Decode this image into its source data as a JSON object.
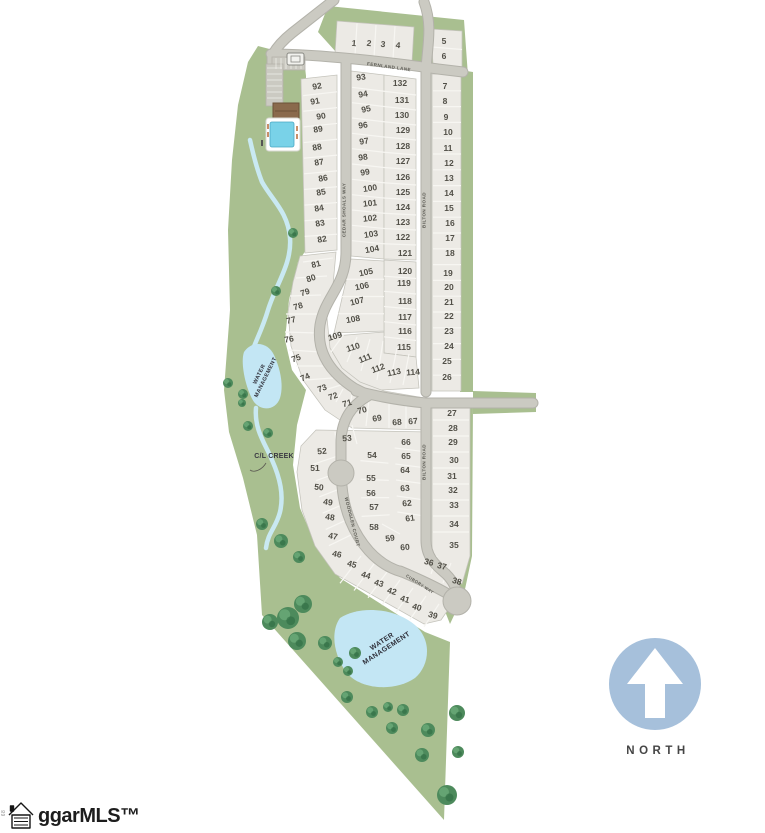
{
  "labels": {
    "fernland_lane": "FERNLAND LANE",
    "cedar_shoals_way": "CEDAR SHOALS WAY",
    "bilton_road_upper": "BILTON ROAD",
    "bilton_road_lower": "BILTON ROAD",
    "woodglen_court": "WOODGLEN COURT",
    "cubory_way": "CUBORY WAY",
    "water_mgmt_upper": "WATER\nMANAGEMENT",
    "water_mgmt_lower": "WATER\nMANAGEMENT",
    "cl_creek": "C/L CREEK",
    "north": "NORTH",
    "logo": "ggarMLS™",
    "edge_mark": "68"
  },
  "colors": {
    "land_green": "#a9bf90",
    "tree_green": "#4d8a5c",
    "lot_fill": "#eceae5",
    "road_fill": "#cbcac2",
    "road_edge": "#b3b2aa",
    "water_blue": "#c3e6f4",
    "pool_blue": "#79d2e8",
    "north_circle": "#a6c0db"
  },
  "lots_format": [
    "label",
    "x",
    "y",
    "rotation_deg"
  ],
  "lots": [
    [
      "1",
      354,
      43,
      6
    ],
    [
      "2",
      369,
      43,
      6
    ],
    [
      "3",
      383,
      44,
      6
    ],
    [
      "4",
      398,
      45,
      6
    ],
    [
      "5",
      444,
      41,
      0
    ],
    [
      "6",
      444,
      56,
      0
    ],
    [
      "7",
      445,
      86,
      0
    ],
    [
      "8",
      445,
      101,
      0
    ],
    [
      "9",
      446,
      117,
      0
    ],
    [
      "10",
      448,
      132,
      0
    ],
    [
      "11",
      448,
      148,
      0
    ],
    [
      "12",
      449,
      163,
      0
    ],
    [
      "13",
      449,
      178,
      0
    ],
    [
      "14",
      449,
      193,
      0
    ],
    [
      "15",
      449,
      208,
      0
    ],
    [
      "16",
      450,
      223,
      0
    ],
    [
      "17",
      450,
      238,
      0
    ],
    [
      "18",
      450,
      253,
      0
    ],
    [
      "19",
      448,
      273,
      0
    ],
    [
      "20",
      449,
      287,
      0
    ],
    [
      "21",
      449,
      302,
      0
    ],
    [
      "22",
      449,
      316,
      0
    ],
    [
      "23",
      449,
      331,
      0
    ],
    [
      "24",
      449,
      346,
      0
    ],
    [
      "25",
      447,
      361,
      0
    ],
    [
      "26",
      447,
      377,
      0
    ],
    [
      "27",
      452,
      413,
      0
    ],
    [
      "28",
      453,
      428,
      0
    ],
    [
      "29",
      453,
      442,
      0
    ],
    [
      "30",
      454,
      460,
      0
    ],
    [
      "31",
      452,
      476,
      0
    ],
    [
      "32",
      453,
      490,
      0
    ],
    [
      "33",
      454,
      505,
      0
    ],
    [
      "34",
      454,
      524,
      0
    ],
    [
      "35",
      454,
      545,
      0
    ],
    [
      "36",
      429,
      562,
      14
    ],
    [
      "37",
      442,
      566,
      14
    ],
    [
      "38",
      457,
      581,
      16
    ],
    [
      "39",
      433,
      615,
      16
    ],
    [
      "40",
      417,
      607,
      16
    ],
    [
      "41",
      405,
      599,
      16
    ],
    [
      "42",
      392,
      591,
      16
    ],
    [
      "43",
      379,
      583,
      16
    ],
    [
      "44",
      366,
      575,
      16
    ],
    [
      "45",
      352,
      564,
      16
    ],
    [
      "46",
      337,
      554,
      12
    ],
    [
      "47",
      333,
      536,
      10
    ],
    [
      "48",
      330,
      517,
      8
    ],
    [
      "49",
      328,
      502,
      8
    ],
    [
      "50",
      319,
      487,
      6
    ],
    [
      "51",
      315,
      468,
      0
    ],
    [
      "52",
      322,
      451,
      -5
    ],
    [
      "53",
      347,
      438,
      -5
    ],
    [
      "54",
      372,
      455,
      0
    ],
    [
      "55",
      371,
      478,
      0
    ],
    [
      "56",
      371,
      493,
      0
    ],
    [
      "57",
      374,
      507,
      0
    ],
    [
      "58",
      374,
      527,
      0
    ],
    [
      "59",
      390,
      538,
      -8
    ],
    [
      "60",
      405,
      547,
      -5
    ],
    [
      "61",
      410,
      518,
      -8
    ],
    [
      "62",
      407,
      503,
      -5
    ],
    [
      "63",
      405,
      488,
      -5
    ],
    [
      "64",
      405,
      470,
      0
    ],
    [
      "65",
      406,
      456,
      0
    ],
    [
      "66",
      406,
      442,
      0
    ],
    [
      "67",
      413,
      421,
      -5
    ],
    [
      "68",
      397,
      422,
      -5
    ],
    [
      "69",
      377,
      418,
      -10
    ],
    [
      "70",
      362,
      410,
      -14
    ],
    [
      "71",
      347,
      403,
      -16
    ],
    [
      "72",
      333,
      396,
      -18
    ],
    [
      "73",
      322,
      388,
      -20
    ],
    [
      "74",
      305,
      377,
      -24
    ],
    [
      "75",
      296,
      358,
      -20
    ],
    [
      "76",
      289,
      339,
      -10
    ],
    [
      "77",
      291,
      320,
      -14
    ],
    [
      "78",
      298,
      306,
      -16
    ],
    [
      "79",
      305,
      292,
      -18
    ],
    [
      "80",
      311,
      278,
      -18
    ],
    [
      "81",
      316,
      264,
      -14
    ],
    [
      "82",
      322,
      239,
      -10
    ],
    [
      "83",
      320,
      223,
      -10
    ],
    [
      "84",
      319,
      208,
      -10
    ],
    [
      "85",
      321,
      192,
      -10
    ],
    [
      "86",
      323,
      178,
      -10
    ],
    [
      "87",
      319,
      162,
      -10
    ],
    [
      "88",
      317,
      147,
      -10
    ],
    [
      "89",
      318,
      129,
      -10
    ],
    [
      "90",
      321,
      116,
      -10
    ],
    [
      "91",
      315,
      101,
      -10
    ],
    [
      "92",
      317,
      86,
      -10
    ],
    [
      "93",
      361,
      77,
      -8
    ],
    [
      "94",
      363,
      94,
      -10
    ],
    [
      "95",
      366,
      109,
      -12
    ],
    [
      "96",
      363,
      125,
      -8
    ],
    [
      "97",
      364,
      141,
      -10
    ],
    [
      "98",
      363,
      157,
      -8
    ],
    [
      "99",
      365,
      172,
      -10
    ],
    [
      "100",
      370,
      188,
      -8
    ],
    [
      "101",
      370,
      203,
      -6
    ],
    [
      "102",
      370,
      218,
      -6
    ],
    [
      "103",
      371,
      234,
      -8
    ],
    [
      "104",
      372,
      249,
      -10
    ],
    [
      "105",
      366,
      272,
      -12
    ],
    [
      "106",
      362,
      286,
      -12
    ],
    [
      "107",
      357,
      301,
      -14
    ],
    [
      "108",
      353,
      319,
      -10
    ],
    [
      "109",
      335,
      336,
      -16
    ],
    [
      "110",
      353,
      347,
      -18
    ],
    [
      "111",
      365,
      358,
      -22
    ],
    [
      "112",
      378,
      368,
      -20
    ],
    [
      "113",
      394,
      372,
      -12
    ],
    [
      "114",
      413,
      372,
      -4
    ],
    [
      "115",
      404,
      347,
      0
    ],
    [
      "116",
      405,
      331,
      0
    ],
    [
      "117",
      405,
      317,
      0
    ],
    [
      "118",
      405,
      301,
      0
    ],
    [
      "119",
      404,
      283,
      0
    ],
    [
      "120",
      405,
      271,
      0
    ],
    [
      "121",
      405,
      253,
      0
    ],
    [
      "122",
      403,
      237,
      0
    ],
    [
      "123",
      403,
      222,
      0
    ],
    [
      "124",
      403,
      207,
      0
    ],
    [
      "125",
      403,
      192,
      0
    ],
    [
      "126",
      403,
      177,
      0
    ],
    [
      "127",
      403,
      161,
      0
    ],
    [
      "128",
      403,
      146,
      0
    ],
    [
      "129",
      403,
      130,
      0
    ],
    [
      "130",
      402,
      115,
      0
    ],
    [
      "131",
      402,
      100,
      0
    ],
    [
      "132",
      400,
      83,
      0
    ]
  ],
  "trees_format": [
    "x",
    "y",
    "radius"
  ],
  "trees": [
    [
      293,
      233,
      5
    ],
    [
      276,
      291,
      5
    ],
    [
      228,
      383,
      5
    ],
    [
      243,
      394,
      5
    ],
    [
      242,
      403,
      4
    ],
    [
      248,
      426,
      5
    ],
    [
      268,
      433,
      5
    ],
    [
      262,
      524,
      6
    ],
    [
      281,
      541,
      7
    ],
    [
      299,
      557,
      6
    ],
    [
      270,
      622,
      8
    ],
    [
      288,
      618,
      11
    ],
    [
      303,
      604,
      9
    ],
    [
      297,
      641,
      9
    ],
    [
      325,
      643,
      7
    ],
    [
      355,
      653,
      6
    ],
    [
      338,
      662,
      5
    ],
    [
      348,
      671,
      5
    ],
    [
      347,
      697,
      6
    ],
    [
      372,
      712,
      6
    ],
    [
      388,
      707,
      5
    ],
    [
      403,
      710,
      6
    ],
    [
      392,
      728,
      6
    ],
    [
      428,
      730,
      7
    ],
    [
      457,
      713,
      8
    ],
    [
      422,
      755,
      7
    ],
    [
      458,
      752,
      6
    ],
    [
      447,
      795,
      10
    ]
  ]
}
